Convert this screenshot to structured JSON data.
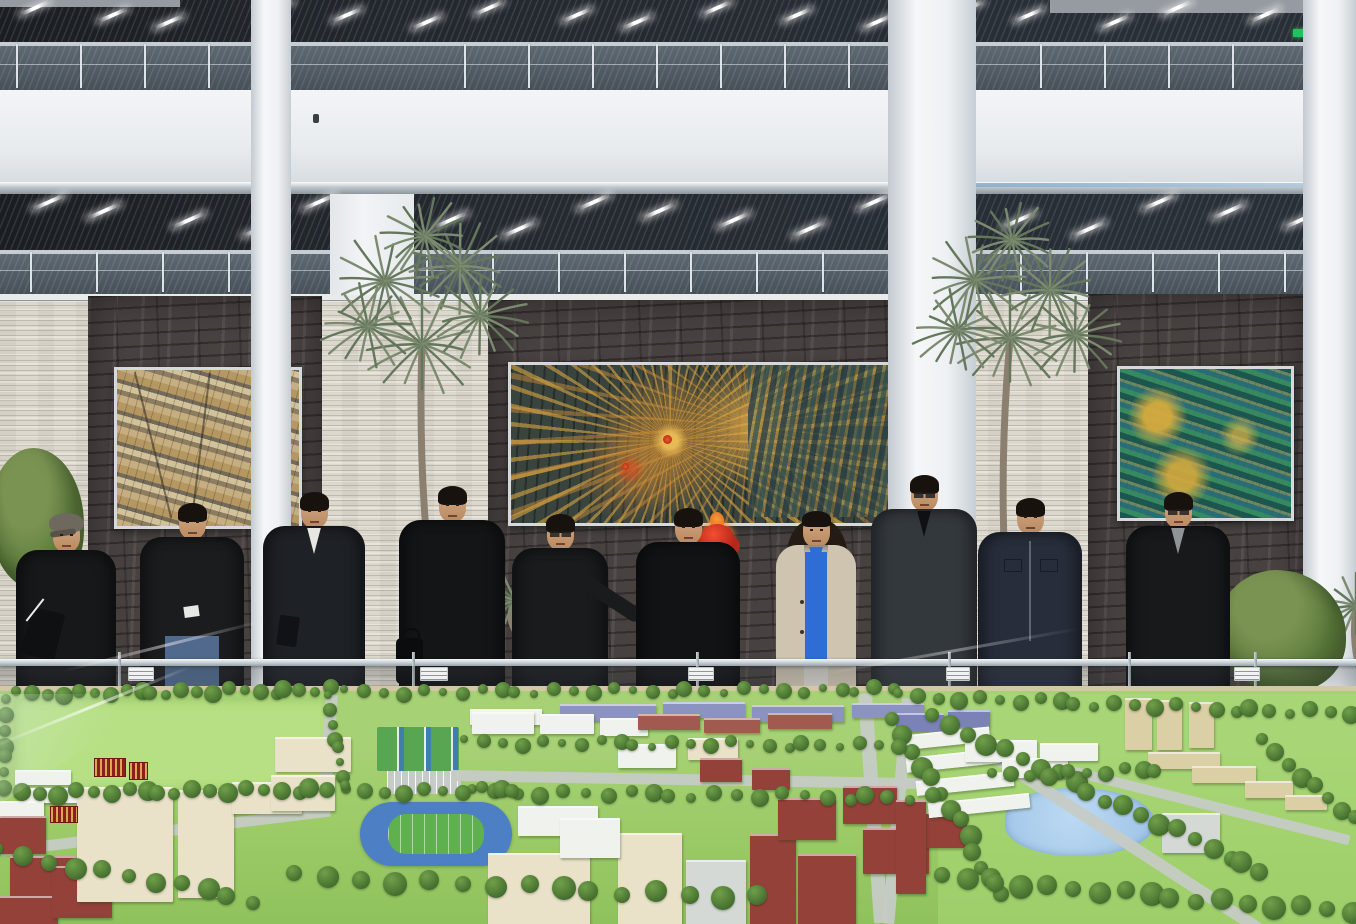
{
  "scene": {
    "description": "Ten officials in dark winter coats stand behind a glass-cased architectural campus scale model inside a bright multi-storey atrium with stone feature walls, three framed mosaic artworks, fan palms and slatted ceilings with linear lights",
    "visible_text": "none legible"
  },
  "colors": {
    "ceiling_slats": "#23282e",
    "fascia": "#eef1f3",
    "stone_wall": "#dcd8cd",
    "dark_panel": "#474140",
    "model_green": "#a7d175",
    "track_blue": "#4d7fc4",
    "pond_blue": "#9cc2e6",
    "artwork_gold": "#d4a93c",
    "artwork_teal": "#2f6f66",
    "ornament_red": "#c22a1e",
    "exit_green": "#21c25e",
    "woman_coat": "#cec4b0",
    "woman_blouse": "#2e6cd6"
  },
  "atrium": {
    "lights_a": [
      18,
      96,
      152,
      262,
      330,
      410,
      472,
      560,
      620,
      700,
      780,
      860,
      952,
      1012,
      1098,
      1160,
      1248,
      1316
    ],
    "lights_b": [
      30,
      85,
      170,
      240,
      300,
      365,
      432,
      500,
      575,
      640,
      715,
      790,
      855,
      930,
      1000,
      1070,
      1140,
      1210,
      1282,
      1330
    ],
    "post_skip": [
      [
        246,
        296
      ],
      [
        884,
        982
      ],
      [
        1298,
        1356
      ],
      [
        330,
        416
      ]
    ],
    "columns": [
      {
        "x": 251,
        "w": 40
      },
      {
        "x": 888,
        "w": 88
      },
      {
        "x": 1303,
        "w": 53
      }
    ],
    "exit_sign": {
      "x": 1293,
      "y": 29,
      "w": 16,
      "h": 8
    },
    "wall_devices": [
      {
        "x": 313,
        "y": 114
      },
      {
        "x": 911,
        "y": 115
      }
    ]
  },
  "palms": [
    {
      "name": "palm-left",
      "x": 330,
      "y": 196,
      "w": 210,
      "h": 380,
      "trunk": [
        100,
        380,
        92,
        150
      ],
      "clusters": [
        [
          92,
          148,
          58
        ],
        [
          55,
          85,
          55
        ],
        [
          130,
          70,
          52
        ],
        [
          38,
          130,
          48
        ],
        [
          150,
          120,
          50
        ],
        [
          95,
          40,
          46
        ]
      ]
    },
    {
      "name": "palm-right",
      "x": 930,
      "y": 210,
      "w": 190,
      "h": 360,
      "trunk": [
        75,
        360,
        80,
        130
      ],
      "clusters": [
        [
          80,
          128,
          56
        ],
        [
          45,
          70,
          52
        ],
        [
          120,
          80,
          50
        ],
        [
          28,
          120,
          46
        ],
        [
          145,
          125,
          48
        ],
        [
          82,
          30,
          45
        ]
      ]
    },
    {
      "name": "palm-sprig-center",
      "x": 470,
      "y": 540,
      "w": 90,
      "h": 90,
      "trunk": [
        45,
        90,
        45,
        62
      ],
      "clusters": [
        [
          45,
          60,
          34
        ]
      ]
    },
    {
      "name": "palm-sprig-right-edge",
      "x": 1322,
      "y": 548,
      "w": 60,
      "h": 130,
      "trunk": [
        40,
        130,
        34,
        60
      ],
      "clusters": [
        [
          34,
          58,
          36
        ]
      ]
    }
  ],
  "people": [
    {
      "name": "man-flat-cap-holding-folder",
      "cx": 66,
      "top": 519,
      "sw": 100,
      "coat": "#17181a",
      "cap": "#6e685e",
      "extras": {
        "folder": true
      }
    },
    {
      "name": "man-black-jacket-jeans",
      "cx": 192,
      "top": 506,
      "sw": 104,
      "coat": "#1b1c1e",
      "hair": true,
      "extras": {
        "jeans": "#50698c",
        "paper": true
      }
    },
    {
      "name": "man-dark-suit-white-collar",
      "cx": 314,
      "top": 495,
      "sw": 102,
      "coat": "#1e2126",
      "hair": true,
      "inner": "#e8e6e0",
      "extras": {
        "notebook": true
      }
    },
    {
      "name": "man-black-coat-with-bag",
      "cx": 452,
      "top": 489,
      "sw": 106,
      "coat": "#141517",
      "hair": true,
      "extras": {
        "bag": true
      }
    },
    {
      "name": "man-glasses-pointing",
      "cx": 560,
      "top": 517,
      "sw": 96,
      "coat": "#191b1d",
      "hair": true,
      "glasses": true,
      "extras": {
        "point": true
      }
    },
    {
      "name": "man-black-coat-center",
      "cx": 688,
      "top": 511,
      "sw": 104,
      "coat": "#121315",
      "hair": true
    },
    {
      "name": "woman-beige-coat-blue-blouse",
      "cx": 816,
      "top": 514,
      "sw": 80,
      "coat": "#cec4b0",
      "woman": true,
      "inner": "#2e6cd6",
      "extras": {
        "pants": "#d6d3cb",
        "buttons": true
      }
    },
    {
      "name": "man-glasses-charcoal-jacket",
      "cx": 924,
      "top": 478,
      "sw": 106,
      "coat": "#33383d",
      "hair": true,
      "glasses": true,
      "inner": "#0f1012"
    },
    {
      "name": "man-navy-pocket-jacket",
      "cx": 1030,
      "top": 501,
      "sw": 104,
      "coat": "#272d3a",
      "hair": true,
      "extras": {
        "pockets": true
      }
    },
    {
      "name": "man-glasses-black-coat-right",
      "cx": 1178,
      "top": 495,
      "sw": 104,
      "coat": "#17191b",
      "hair": true,
      "glasses": true,
      "inner": "#8f9497"
    }
  ],
  "display_case": {
    "rail_y": 659,
    "posts": [
      118,
      412,
      696,
      948,
      1128,
      1254
    ],
    "labels": [
      {
        "x": 128,
        "w": 24
      },
      {
        "x": 420,
        "w": 26
      },
      {
        "x": 688,
        "w": 24
      },
      {
        "x": 946,
        "w": 22
      },
      {
        "x": 1234,
        "w": 24
      }
    ]
  },
  "model": {
    "building_colors": {
      "cream": "#e9e1c8",
      "white": "#f0f2ee",
      "red": "#94413a",
      "tan": "#dbcfa6",
      "purple": "#8d93c0",
      "gray": "#d5d9d6",
      "redlight": "#a05a50",
      "blue": "#7b82b8"
    },
    "buildings": [
      [
        560,
        18,
        96,
        15,
        "purple"
      ],
      [
        663,
        16,
        82,
        14,
        "purple"
      ],
      [
        752,
        19,
        92,
        15,
        "purple"
      ],
      [
        852,
        17,
        72,
        13,
        "purple"
      ],
      [
        470,
        23,
        72,
        14,
        "white"
      ],
      [
        15,
        84,
        56,
        13,
        "white"
      ],
      [
        24,
        102,
        62,
        13,
        "white"
      ],
      [
        0,
        115,
        44,
        30,
        "white"
      ],
      [
        0,
        130,
        46,
        36,
        "red"
      ],
      [
        10,
        170,
        66,
        44,
        "red"
      ],
      [
        0,
        210,
        58,
        28,
        "red"
      ],
      [
        52,
        180,
        60,
        50,
        "red"
      ],
      [
        80,
        116,
        32,
        44,
        "red"
      ],
      [
        77,
        101,
        96,
        113,
        "cream",
        1
      ],
      [
        178,
        104,
        56,
        106,
        "cream",
        1
      ],
      [
        232,
        96,
        70,
        30,
        "cream"
      ],
      [
        275,
        51,
        76,
        33,
        "cream"
      ],
      [
        271,
        89,
        64,
        34,
        "cream"
      ],
      [
        472,
        26,
        62,
        20,
        "white"
      ],
      [
        540,
        28,
        54,
        18,
        "white"
      ],
      [
        600,
        32,
        48,
        16,
        "white"
      ],
      [
        618,
        58,
        58,
        22,
        "white"
      ],
      [
        688,
        52,
        50,
        20,
        "cream"
      ],
      [
        638,
        28,
        62,
        14,
        "redlight"
      ],
      [
        704,
        32,
        56,
        13,
        "redlight"
      ],
      [
        768,
        27,
        64,
        14,
        "redlight"
      ],
      [
        700,
        72,
        42,
        22,
        "red"
      ],
      [
        752,
        82,
        38,
        20,
        "red"
      ],
      [
        896,
        27,
        48,
        17,
        "blue"
      ],
      [
        948,
        24,
        42,
        15,
        "blue"
      ],
      [
        518,
        120,
        80,
        28,
        "white"
      ],
      [
        488,
        167,
        102,
        71,
        "cream",
        1
      ],
      [
        618,
        147,
        64,
        91,
        "cream",
        1
      ],
      [
        560,
        132,
        60,
        38,
        "white"
      ],
      [
        686,
        174,
        60,
        64,
        "gray"
      ],
      [
        750,
        148,
        46,
        90,
        "red",
        1
      ],
      [
        798,
        168,
        58,
        70,
        "red"
      ],
      [
        778,
        112,
        58,
        40,
        "red"
      ],
      [
        843,
        100,
        54,
        36,
        "red"
      ],
      [
        863,
        142,
        66,
        44,
        "red"
      ],
      [
        925,
        126,
        42,
        34,
        "red"
      ],
      [
        900,
        45,
        90,
        13,
        "white",
        0,
        -6
      ],
      [
        906,
        67,
        94,
        13,
        "white",
        0,
        -6
      ],
      [
        916,
        90,
        98,
        13,
        "white",
        0,
        -6
      ],
      [
        928,
        112,
        102,
        13,
        "white",
        0,
        -6
      ],
      [
        965,
        54,
        72,
        20,
        "white"
      ],
      [
        1002,
        72,
        66,
        18,
        "white"
      ],
      [
        1040,
        57,
        58,
        16,
        "white"
      ],
      [
        1125,
        12,
        27,
        50,
        "tan",
        1
      ],
      [
        1157,
        14,
        25,
        48,
        "tan",
        1
      ],
      [
        1189,
        16,
        25,
        44,
        "tan",
        1
      ],
      [
        1148,
        66,
        72,
        15,
        "tan"
      ],
      [
        1192,
        80,
        64,
        15,
        "tan"
      ],
      [
        1245,
        95,
        48,
        15,
        "tan"
      ],
      [
        1285,
        109,
        42,
        13,
        "tan"
      ],
      [
        1162,
        127,
        58,
        38,
        "gray"
      ],
      [
        896,
        114,
        30,
        92,
        "red",
        1
      ]
    ],
    "roads": [
      [
        326,
        8,
        12,
        112,
        4
      ],
      [
        452,
        84,
        492,
        11,
        1
      ],
      [
        858,
        8,
        14,
        230,
        -4
      ],
      [
        936,
        26,
        430,
        12,
        33
      ],
      [
        902,
        12,
        12,
        226,
        5
      ],
      [
        0,
        160,
        332,
        11,
        -7
      ],
      [
        1040,
        72,
        320,
        10,
        14
      ]
    ],
    "tree_rows": [
      [
        20,
        8,
        332,
        4,
        22,
        7
      ],
      [
        8,
        107,
        330,
        104,
        20,
        8
      ],
      [
        10,
        16,
        2,
        100,
        7,
        7
      ],
      [
        348,
        6,
        896,
        4,
        30,
        6
      ],
      [
        902,
        10,
        1350,
        28,
        24,
        7
      ],
      [
        936,
        32,
        1262,
        186,
        20,
        9
      ],
      [
        896,
        36,
        1002,
        208,
        13,
        9
      ],
      [
        468,
        56,
        898,
        60,
        24,
        6
      ],
      [
        476,
        106,
        934,
        112,
        22,
        7
      ],
      [
        298,
        190,
        756,
        212,
        15,
        10
      ],
      [
        350,
        106,
        516,
        104,
        10,
        7
      ],
      [
        996,
        90,
        1158,
        84,
        10,
        7
      ],
      [
        946,
        192,
        1350,
        226,
        17,
        10
      ],
      [
        0,
        166,
        256,
        214,
        11,
        9
      ],
      [
        332,
        12,
        342,
        102,
        8,
        6
      ],
      [
        1266,
        56,
        1352,
        134,
        8,
        8
      ]
    ],
    "signs": [
      [
        50,
        120,
        26,
        15
      ],
      [
        94,
        72,
        30,
        17
      ],
      [
        129,
        76,
        17,
        16
      ]
    ]
  }
}
